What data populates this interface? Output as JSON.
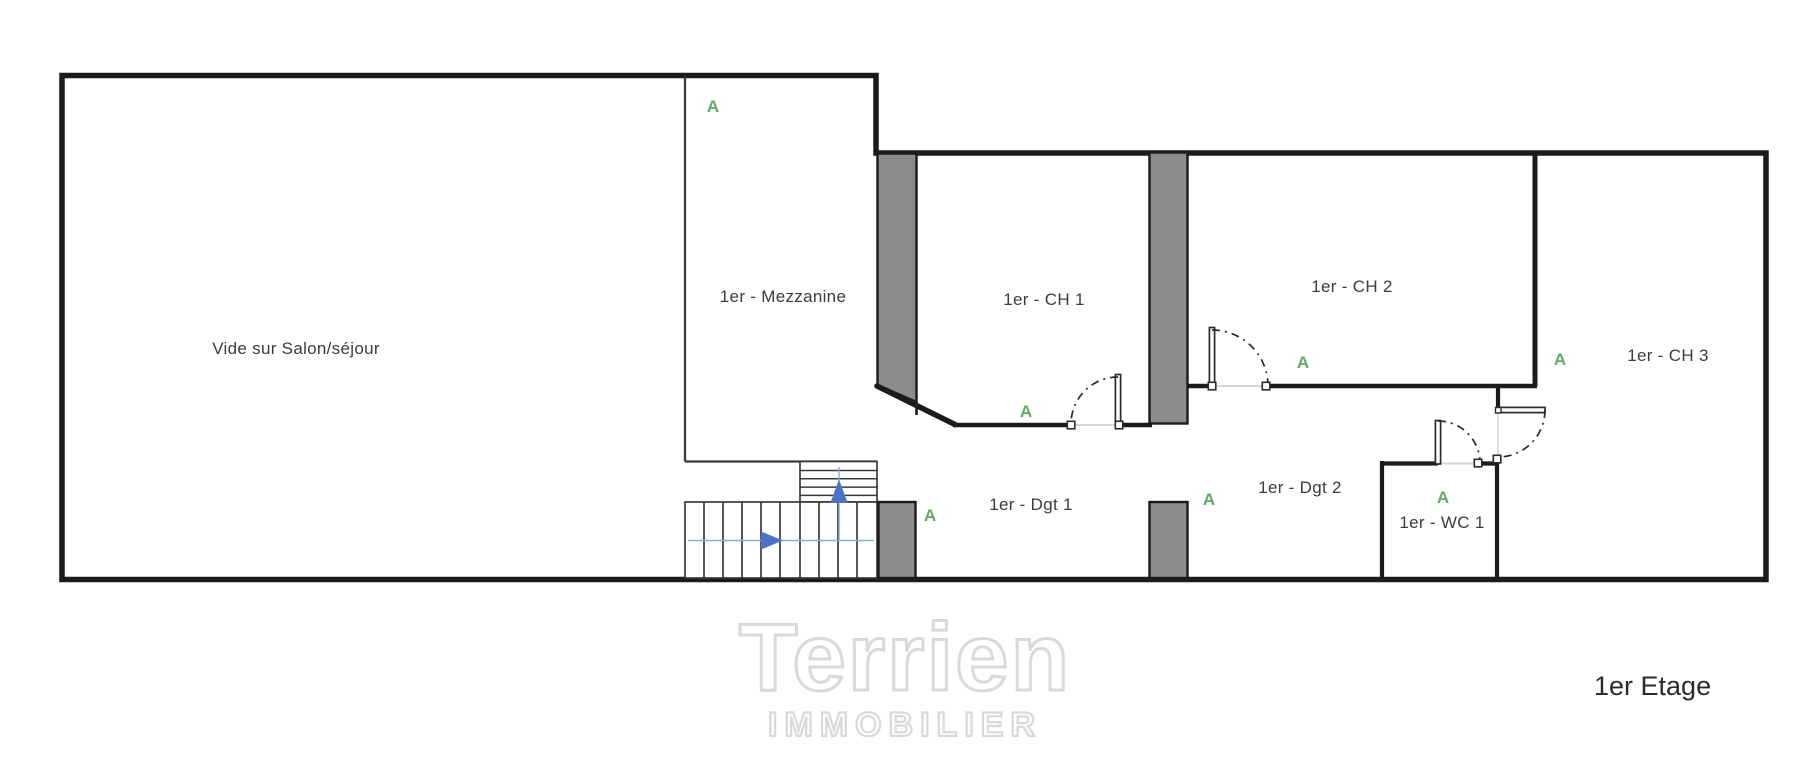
{
  "floorplan": {
    "floor_title": "1er Etage",
    "watermark": {
      "brand": "Terrien",
      "tagline": "IMMOBILIER"
    },
    "rooms": [
      {
        "name": "Vide sur Salon/séjour"
      },
      {
        "name": "1er - Mezzanine"
      },
      {
        "name": "1er - CH 1"
      },
      {
        "name": "1er - CH 2"
      },
      {
        "name": "1er - CH 3"
      },
      {
        "name": "1er - Dgt 1"
      },
      {
        "name": "1er - Dgt 2"
      },
      {
        "name": "1er - WC 1"
      }
    ],
    "section_markers": [
      {
        "text": "A"
      },
      {
        "text": "A"
      },
      {
        "text": "A"
      },
      {
        "text": "A"
      },
      {
        "text": "A"
      },
      {
        "text": "A"
      },
      {
        "text": "A"
      }
    ],
    "colors": {
      "wall": "#1b1b1b",
      "wall_thin": "#3a3a3a",
      "wall_gray": "#8b8b8b",
      "door_opening": "#d6d6d6",
      "arc": "#2b2b2b",
      "marker_green": "#61a96b",
      "arrow_blue": "#4a73c8",
      "arrow_blue_light": "#8fa9d9",
      "watermark_gray": "#d9d9d9",
      "text": "#3c3c3c"
    }
  }
}
